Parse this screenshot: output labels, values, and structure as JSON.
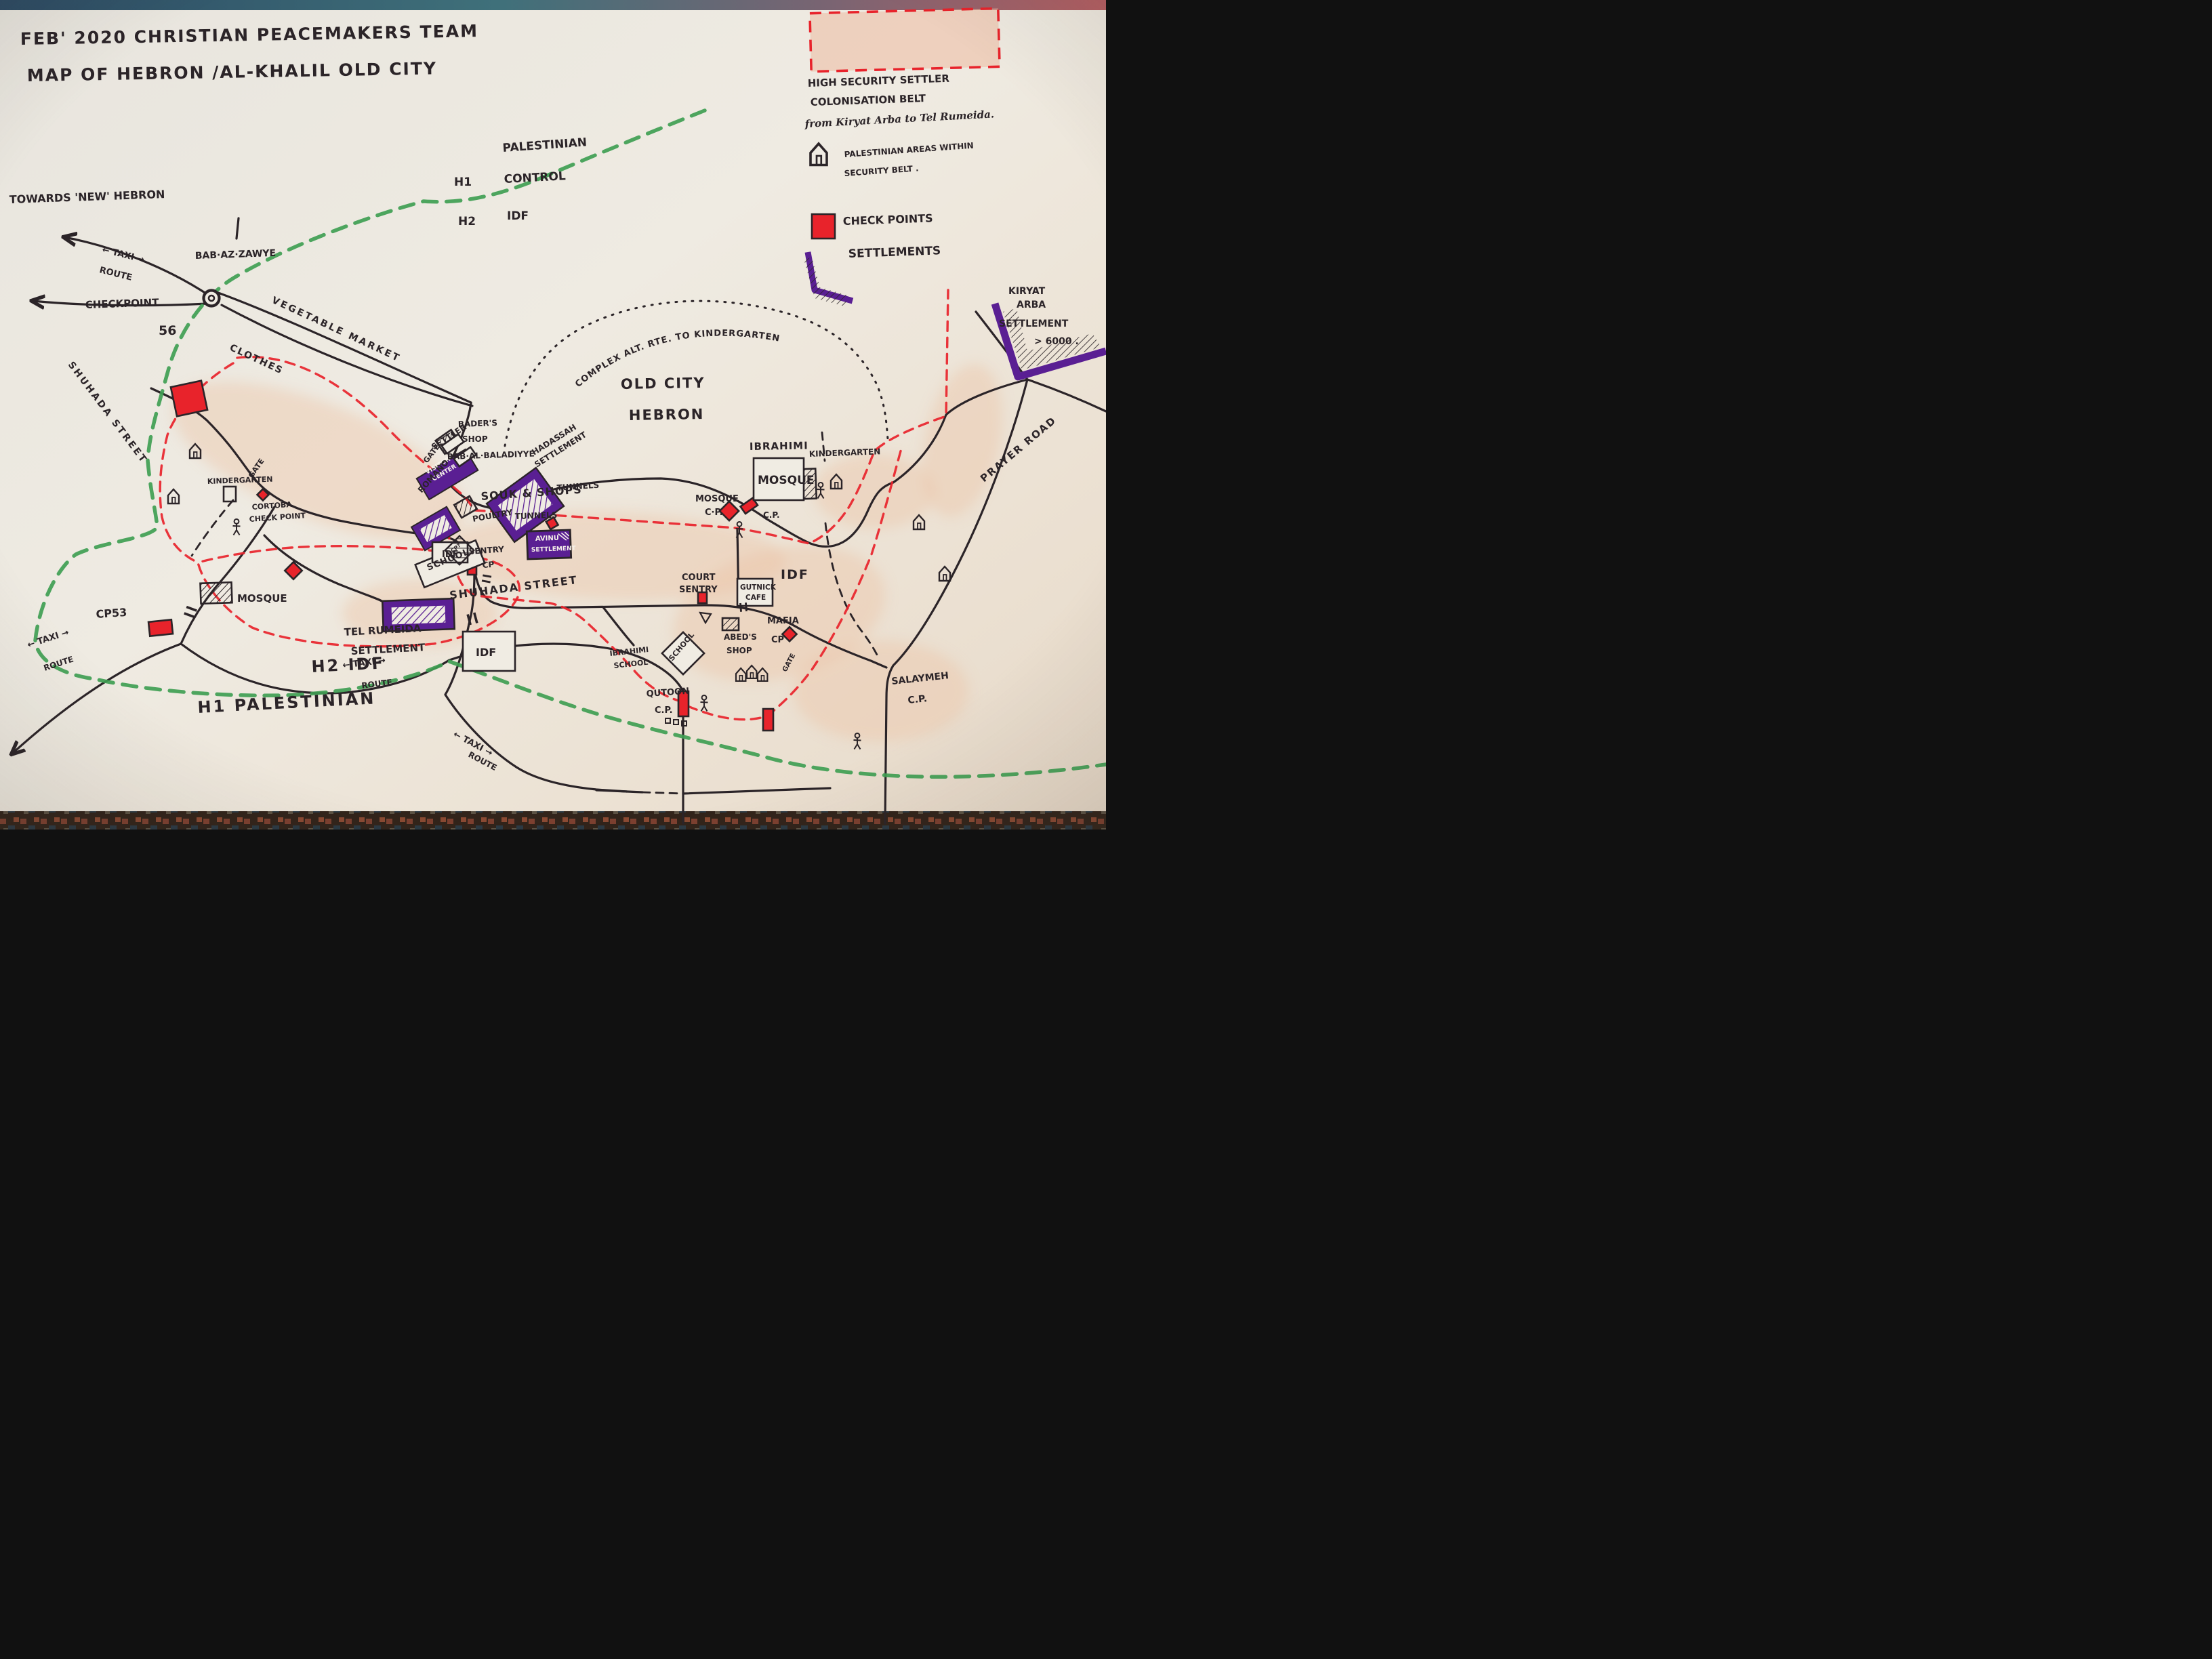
{
  "map_type": "hand-drawn city map",
  "colors": {
    "ink": "#2b2428",
    "checkpoint_red": "#e8232b",
    "boundary_green": "#3f9e52",
    "settlement_purple": "#5a1f93",
    "paper": "#eae7e0",
    "belt_pink_wash": "#ecc3a8"
  },
  "icons": {
    "house": "pentagon house outline = Palestinian area",
    "person": "stick figure",
    "checkpoint": "red filled square/diamond",
    "settlement": "purple box with hatching",
    "roundabout": "double circle",
    "gate": "double bar across road"
  },
  "title": {
    "line1": "FEB' 2020  CHRISTIAN PEACEMAKERS TEAM",
    "line2": "MAP OF HEBRON /AL-KHALIL OLD CITY"
  },
  "legend": {
    "belt1": "HIGH SECURITY SETTLER",
    "belt2": "COLONISATION BELT",
    "belt3": "from Kiryat Arba to Tel Rumeida.",
    "areas1": "PALESTINIAN AREAS WITHIN",
    "areas2": "SECURITY BELT .",
    "checkpoints": "CHECK POINTS",
    "settlements": "SETTLEMENTS"
  },
  "labels": [
    {
      "text": "TOWARDS 'NEW' HEBRON"
    },
    {
      "text": "← TAXI →"
    },
    {
      "text": "ROUTE"
    },
    {
      "text": "BAB·AZ·ZAWYE"
    },
    {
      "text": "PALESTINIAN"
    },
    {
      "text": "H1"
    },
    {
      "text": "CONTROL"
    },
    {
      "text": "H2"
    },
    {
      "text": "IDF"
    },
    {
      "text": "VEGETABLE MARKET"
    },
    {
      "text": "CLOTHES"
    },
    {
      "text": "CHECKPOINT"
    },
    {
      "text": "56"
    },
    {
      "text": "SHUHADA STREET"
    },
    {
      "text": "GATE"
    },
    {
      "text": "KINDERGARTEN"
    },
    {
      "text": "CORTOBA"
    },
    {
      "text": "CHECK POINT"
    },
    {
      "text": "SETTLER"
    },
    {
      "text": "VISITOR"
    },
    {
      "text": "CENTER"
    },
    {
      "text": "HADASSAH"
    },
    {
      "text": "SETTLEMENT"
    },
    {
      "text": "BADER'S"
    },
    {
      "text": "SHOP"
    },
    {
      "text": "GATE"
    },
    {
      "text": "BAB·AL·BALADIYYE"
    },
    {
      "text": "ROMANO"
    },
    {
      "text": "IDF"
    },
    {
      "text": "POULTRY"
    },
    {
      "text": "SOUK & SHOPS"
    },
    {
      "text": "TUNNELS"
    },
    {
      "text": "TUNNELS"
    },
    {
      "text": "OLD CITY"
    },
    {
      "text": "HEBRON"
    },
    {
      "text": "COMPLEX ALT. RTE. TO KINDERGARTEN"
    },
    {
      "text": "SCHOOL"
    },
    {
      "text": "IBRAHIMI"
    },
    {
      "text": "MOSQUE"
    },
    {
      "text": "KINDERGARTEN"
    },
    {
      "text": "MOSQUE"
    },
    {
      "text": "C·P."
    },
    {
      "text": "C.P."
    },
    {
      "text": "COURT"
    },
    {
      "text": "SENTRY"
    },
    {
      "text": "GUTNICK"
    },
    {
      "text": "CAFE"
    },
    {
      "text": "IDF"
    },
    {
      "text": "ABED'S"
    },
    {
      "text": "SHOP"
    },
    {
      "text": "MAFIA"
    },
    {
      "text": "CP"
    },
    {
      "text": "GATE"
    },
    {
      "text": "SCHOOL"
    },
    {
      "text": "IBRAHIMI"
    },
    {
      "text": "SCHOOL"
    },
    {
      "text": "QUTOON"
    },
    {
      "text": "C.P."
    },
    {
      "text": "SALAYMEH"
    },
    {
      "text": "C.P."
    },
    {
      "text": "H2 IDF"
    },
    {
      "text": "H1 PALESTINIAN"
    },
    {
      "text": "CP53"
    },
    {
      "text": "MOSQUE"
    },
    {
      "text": "TEL RUMEIDA"
    },
    {
      "text": "SETTLEMENT"
    },
    {
      "text": "IDF"
    },
    {
      "text": "← TAXI →"
    },
    {
      "text": "ROUTE"
    },
    {
      "text": "← TAXI →"
    },
    {
      "text": "ROUTE"
    },
    {
      "text": "← TAXI →"
    },
    {
      "text": "ROUTE"
    },
    {
      "text": "PRAYER ROAD"
    },
    {
      "text": "KIRYAT"
    },
    {
      "text": "ARBA"
    },
    {
      "text": "SETTLEMENT"
    },
    {
      "text": "> 6000 ."
    },
    {
      "text": "AVINU"
    },
    {
      "text": "SETTLEMENT"
    },
    {
      "text": "SENTRY"
    },
    {
      "text": "CP"
    },
    {
      "text": "CP?"
    },
    {
      "text": "SHUHADA STREET"
    }
  ]
}
